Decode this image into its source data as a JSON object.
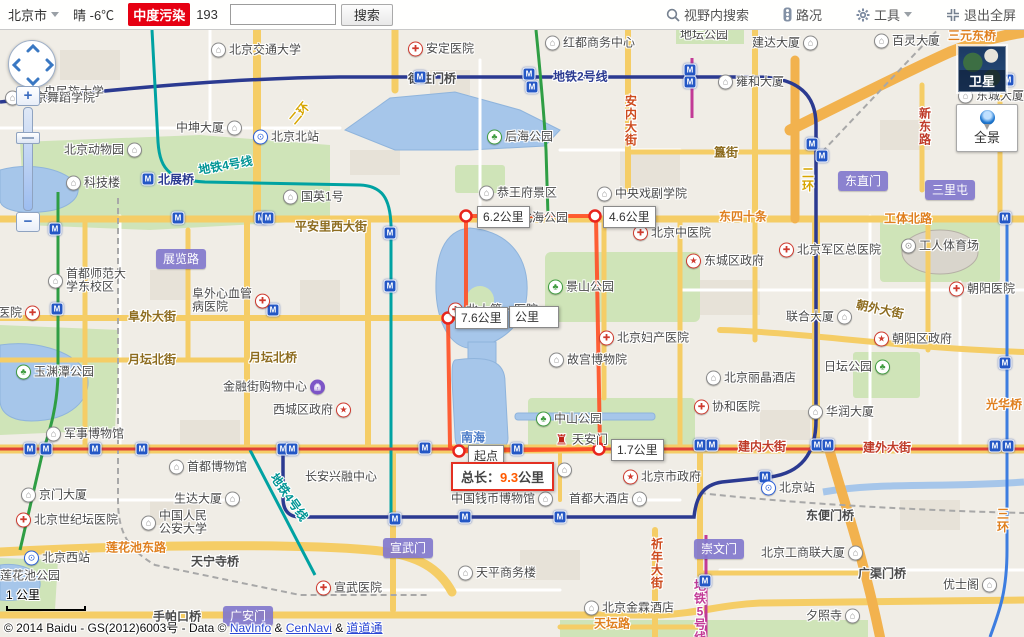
{
  "header": {
    "city": "北京市",
    "weather": "晴 -6℃",
    "aqi_label": "中度污染",
    "aqi_value": "193",
    "search_placeholder": "",
    "search_button": "搜索",
    "view_search": "视野内搜索",
    "traffic": "路况",
    "tools": "工具",
    "exit_fullscreen": "退出全屏"
  },
  "controls": {
    "satellite": "卫星",
    "panorama": "全景",
    "zoom_in": "+",
    "zoom_out": "−",
    "scale": "1 公里"
  },
  "route": {
    "total_prefix": "总长：",
    "total_value": "9.3",
    "total_unit": "公里",
    "start": "起点",
    "segments": [
      {
        "t": "6.2公里",
        "x": 477,
        "y": 176
      },
      {
        "t": "4.6公里",
        "x": 603,
        "y": 176
      },
      {
        "t": "7.6公里",
        "x": 455,
        "y": 277
      },
      {
        "t": "1.7公里",
        "x": 611,
        "y": 409
      }
    ],
    "fragment": {
      "t": "公里",
      "x": 509,
      "y": 276
    }
  },
  "copyright": {
    "prefix": "© 2014 Baidu - GS(2012)6003号 - Data © ",
    "link1": "NavInfo",
    "amp1": " & ",
    "link2": "CenNavi",
    "amp2": " & ",
    "link3": "道道通"
  },
  "map": {
    "pois": [
      [
        44,
        62,
        null,
        "央民族大学"
      ],
      [
        211,
        20,
        "school",
        "北京交通大学"
      ],
      [
        5,
        68,
        "school",
        "北京舞蹈学院"
      ],
      [
        176,
        98,
        "building",
        "中坤大厦",
        "r"
      ],
      [
        253,
        107,
        "station",
        "北京北站"
      ],
      [
        64,
        120,
        "building",
        "北京动物园",
        "r"
      ],
      [
        66,
        153,
        "building",
        "科技楼"
      ],
      [
        283,
        167,
        "building",
        "国英1号"
      ],
      [
        545,
        13,
        "building",
        "红都商务中心"
      ],
      [
        408,
        19,
        "hospital",
        "安定医院"
      ],
      [
        487,
        107,
        "park",
        "后海公园"
      ],
      [
        479,
        163,
        "sight",
        "恭王府景区"
      ],
      [
        597,
        164,
        "school",
        "中央戏剧学院"
      ],
      [
        752,
        13,
        "building",
        "建达大厦",
        "r"
      ],
      [
        874,
        11,
        "building",
        "百灵大厦"
      ],
      [
        718,
        52,
        "building",
        "雍和大厦"
      ],
      [
        958,
        66,
        "building",
        "东城大厦"
      ],
      [
        680,
        5,
        null,
        "地坛公园"
      ],
      [
        48,
        251,
        "school",
        "首都师范大\n学东校区"
      ],
      [
        192,
        271,
        "hospital",
        "阜外心血管\n病医院",
        "r"
      ],
      [
        -2,
        283,
        "hospital",
        "医院",
        "r"
      ],
      [
        502,
        188,
        "park",
        "北海公园"
      ],
      [
        548,
        257,
        "park",
        "景山公园"
      ],
      [
        448,
        280,
        "hospital",
        "北大第一医院"
      ],
      [
        633,
        203,
        "hospital",
        "北京中医院"
      ],
      [
        686,
        231,
        "gov",
        "东城区政府"
      ],
      [
        779,
        220,
        "hospital",
        "北京军区总医院"
      ],
      [
        901,
        216,
        "stadium",
        "工人体育场"
      ],
      [
        949,
        259,
        "hospital",
        "朝阳医院"
      ],
      [
        786,
        287,
        "building",
        "联合大厦",
        "r"
      ],
      [
        874,
        309,
        "gov",
        "朝阳区政府"
      ],
      [
        599,
        308,
        "hospital",
        "北京妇产医院"
      ],
      [
        549,
        330,
        "building",
        "故宫博物院"
      ],
      [
        824,
        337,
        "park",
        "日坛公园",
        "r"
      ],
      [
        706,
        348,
        "hotel",
        "北京丽晶酒店"
      ],
      [
        16,
        342,
        "park",
        "玉渊潭公园"
      ],
      [
        223,
        357,
        "shopping",
        "金融街购物中心",
        "r"
      ],
      [
        273,
        380,
        "gov",
        "西城区政府",
        "r"
      ],
      [
        536,
        389,
        "park",
        "中山公园"
      ],
      [
        554,
        410,
        "tiananmen",
        "天安门"
      ],
      [
        46,
        404,
        "building",
        "军事博物馆"
      ],
      [
        169,
        437,
        "building",
        "首都博物馆"
      ],
      [
        21,
        465,
        "building",
        "京门大厦"
      ],
      [
        174,
        469,
        "building",
        "生达大厦",
        "r"
      ],
      [
        305,
        447,
        null,
        "长安兴融中心"
      ],
      [
        623,
        447,
        "gov",
        "北京市政府"
      ],
      [
        518,
        440,
        "building",
        "博物馆",
        "r"
      ],
      [
        451,
        469,
        "building",
        "中国钱币博物馆",
        "r"
      ],
      [
        569,
        469,
        "hotel",
        "首都大酒店",
        "r"
      ],
      [
        694,
        377,
        "hospital",
        "协和医院"
      ],
      [
        808,
        382,
        "building",
        "华润大厦"
      ],
      [
        761,
        458,
        "station",
        "北京站"
      ],
      [
        141,
        493,
        "school",
        "中国人民\n公安大学"
      ],
      [
        16,
        490,
        "hospital",
        "北京世纪坛医院"
      ],
      [
        24,
        528,
        "station",
        "北京西站"
      ],
      [
        0,
        546,
        null,
        "莲花池公园"
      ],
      [
        316,
        558,
        "hospital",
        "宣武医院"
      ],
      [
        458,
        543,
        "building",
        "天平商务楼"
      ],
      [
        584,
        578,
        "hotel",
        "北京金霖酒店"
      ],
      [
        761,
        523,
        "building",
        "北京工商联大厦",
        "r"
      ],
      [
        943,
        555,
        "building",
        "优士阁",
        "r"
      ],
      [
        806,
        586,
        "building",
        "夕照寺",
        "r"
      ]
    ],
    "roads": [
      [
        295,
        196,
        "平安里西大街",
        "brown",
        null
      ],
      [
        128,
        286,
        "阜外大街",
        "brown",
        null
      ],
      [
        128,
        329,
        "月坛北街",
        "brown",
        null
      ],
      [
        249,
        327,
        "月坛北桥",
        "brown",
        null
      ],
      [
        106,
        517,
        "莲花池东路",
        "orange",
        null
      ],
      [
        408,
        48,
        "德胜门桥",
        "dark",
        null
      ],
      [
        714,
        122,
        "簋街",
        "brown",
        null
      ],
      [
        719,
        186,
        "东四十条",
        "orange",
        null
      ],
      [
        884,
        188,
        "工体北路",
        "orange",
        null
      ],
      [
        856,
        279,
        "朝外大街",
        "brown",
        12
      ],
      [
        738,
        416,
        "建内大街",
        "red",
        null
      ],
      [
        863,
        417,
        "建外大街",
        "red",
        null
      ],
      [
        986,
        374,
        "光华桥",
        "orange",
        null
      ],
      [
        806,
        485,
        "东便门桥",
        "dark",
        null
      ],
      [
        191,
        531,
        "天宁寺桥",
        "dark",
        null
      ],
      [
        153,
        586,
        "手帕口桥",
        "dark",
        null
      ],
      [
        858,
        543,
        "广渠门桥",
        "dark",
        null
      ],
      [
        594,
        593,
        "天坛路",
        "orange",
        null
      ],
      [
        650,
        534,
        "祈年大街",
        "redorange",
        "v"
      ],
      [
        918,
        97,
        "新东路",
        "red",
        "v"
      ],
      [
        624,
        91,
        "安内大街",
        "redorange",
        "v"
      ],
      [
        996,
        491,
        "三环",
        "orange",
        "v"
      ],
      [
        287,
        83,
        "二环",
        "yellow",
        -50
      ],
      [
        801,
        150,
        "二环",
        "yellow",
        "v"
      ],
      [
        948,
        5,
        "三元东桥",
        "orange",
        null
      ],
      [
        553,
        46,
        "地铁2号线",
        "blue",
        null
      ],
      [
        198,
        135,
        "地铁4号线",
        "teal",
        -10
      ],
      [
        262,
        467,
        "地铁4号线",
        "teal",
        55
      ],
      [
        693,
        582,
        "地铁5号线",
        "magenta",
        "v"
      ],
      [
        158,
        149,
        "北展桥",
        "blue",
        null
      ],
      [
        461,
        407,
        "南海",
        "water",
        null
      ]
    ],
    "badges": [
      [
        156,
        229,
        "展览路"
      ],
      [
        838,
        151,
        "东直门"
      ],
      [
        925,
        160,
        "三里屯"
      ],
      [
        383,
        518,
        "宣武门"
      ],
      [
        694,
        519,
        "崇文门"
      ],
      [
        223,
        586,
        "广安门"
      ]
    ],
    "metro_icons": [
      [
        420,
        47
      ],
      [
        529,
        44
      ],
      [
        532,
        57
      ],
      [
        690,
        40
      ],
      [
        690,
        52
      ],
      [
        812,
        114
      ],
      [
        822,
        126
      ],
      [
        1008,
        50
      ],
      [
        148,
        149
      ],
      [
        390,
        203
      ],
      [
        390,
        256
      ],
      [
        55,
        199
      ],
      [
        178,
        188
      ],
      [
        261,
        188
      ],
      [
        268,
        188
      ],
      [
        57,
        279
      ],
      [
        273,
        280
      ],
      [
        30,
        419
      ],
      [
        46,
        419
      ],
      [
        95,
        419
      ],
      [
        142,
        419
      ],
      [
        283,
        419
      ],
      [
        292,
        419
      ],
      [
        425,
        418
      ],
      [
        517,
        419
      ],
      [
        700,
        415
      ],
      [
        712,
        415
      ],
      [
        765,
        447
      ],
      [
        817,
        415
      ],
      [
        828,
        415
      ],
      [
        995,
        416
      ],
      [
        1008,
        416
      ],
      [
        395,
        489
      ],
      [
        465,
        487
      ],
      [
        560,
        487
      ],
      [
        705,
        551
      ],
      [
        1005,
        188
      ],
      [
        1005,
        333
      ]
    ]
  }
}
